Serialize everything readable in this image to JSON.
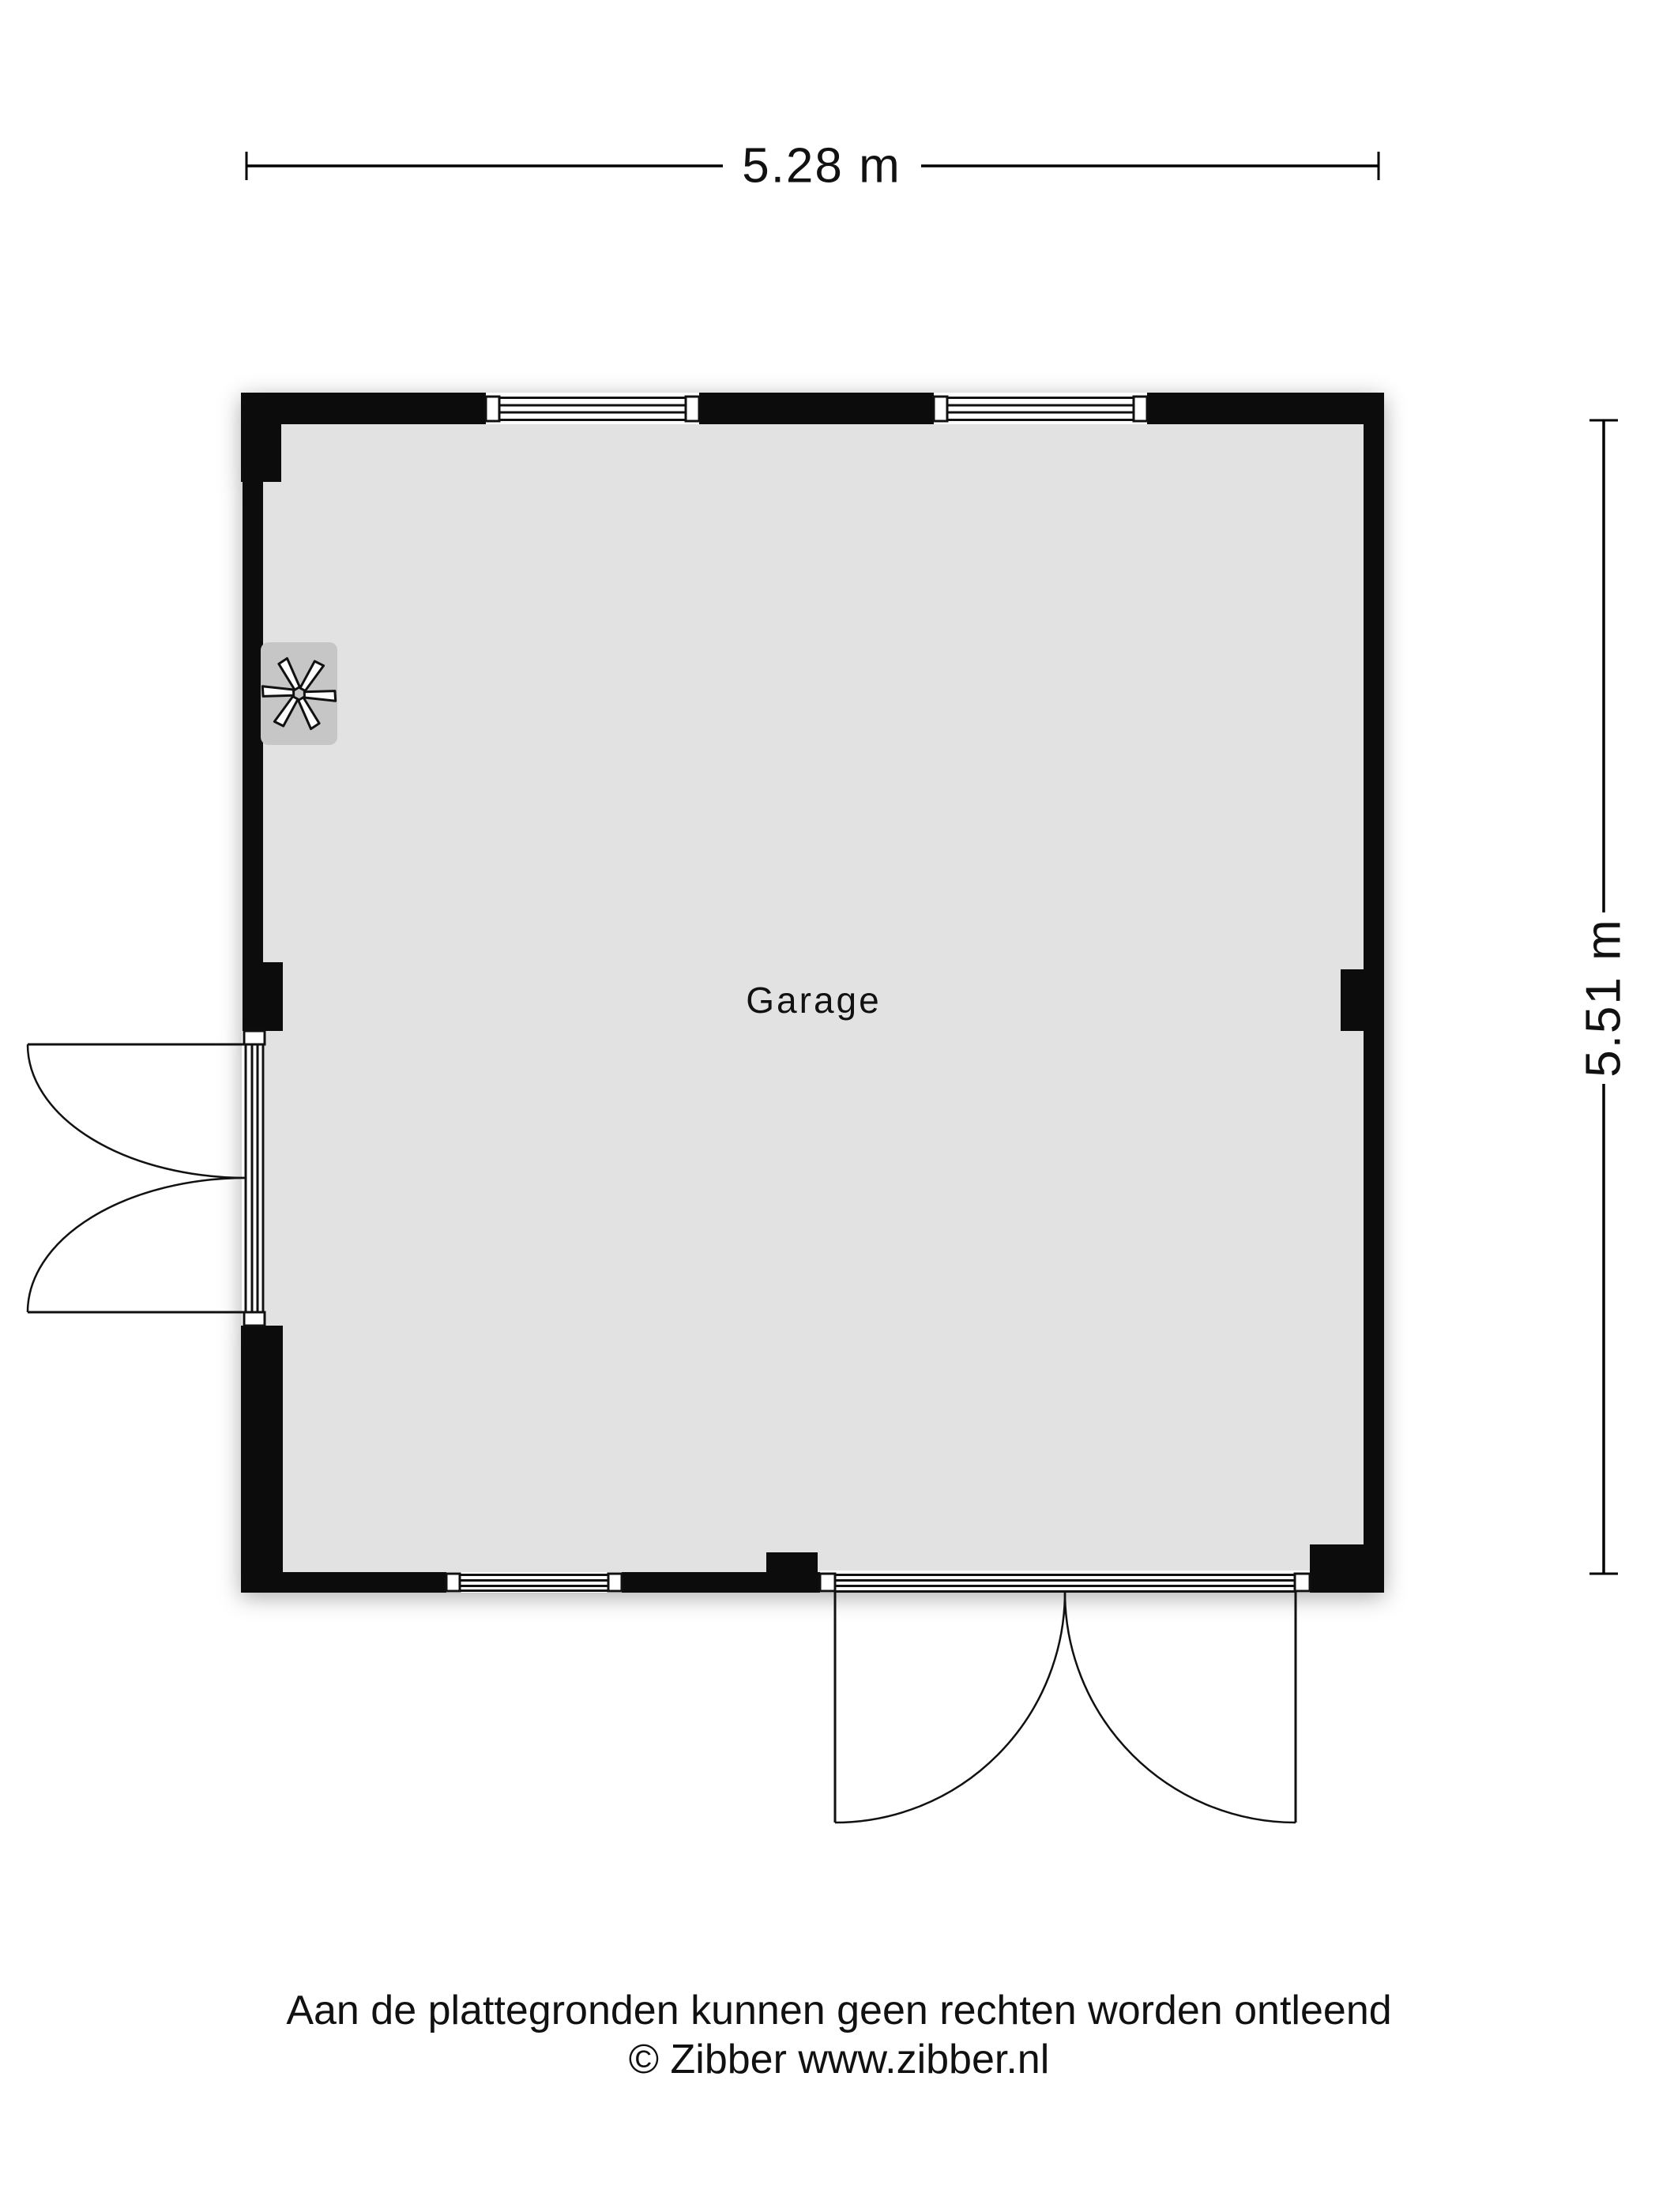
{
  "title": "Floor plan — Garage",
  "dimensions": {
    "width_label": "5.28 m",
    "height_label": "5.51 m",
    "width_m": 5.28,
    "height_m": 5.51
  },
  "room": {
    "name": "Garage"
  },
  "icons": {
    "ventilation_fan": "six-blade-ventilation-fan"
  },
  "footer": {
    "line1": "Aan de plattegronden kunnen geen rechten worden ontleend",
    "line2": "© Zibber www.zibber.nl"
  },
  "colors": {
    "background": "#ffffff",
    "wall": "#0c0c0c",
    "floor": "#e2e2e2",
    "fan_background": "#c6c6c6",
    "line": "#111111",
    "text": "#111111"
  }
}
